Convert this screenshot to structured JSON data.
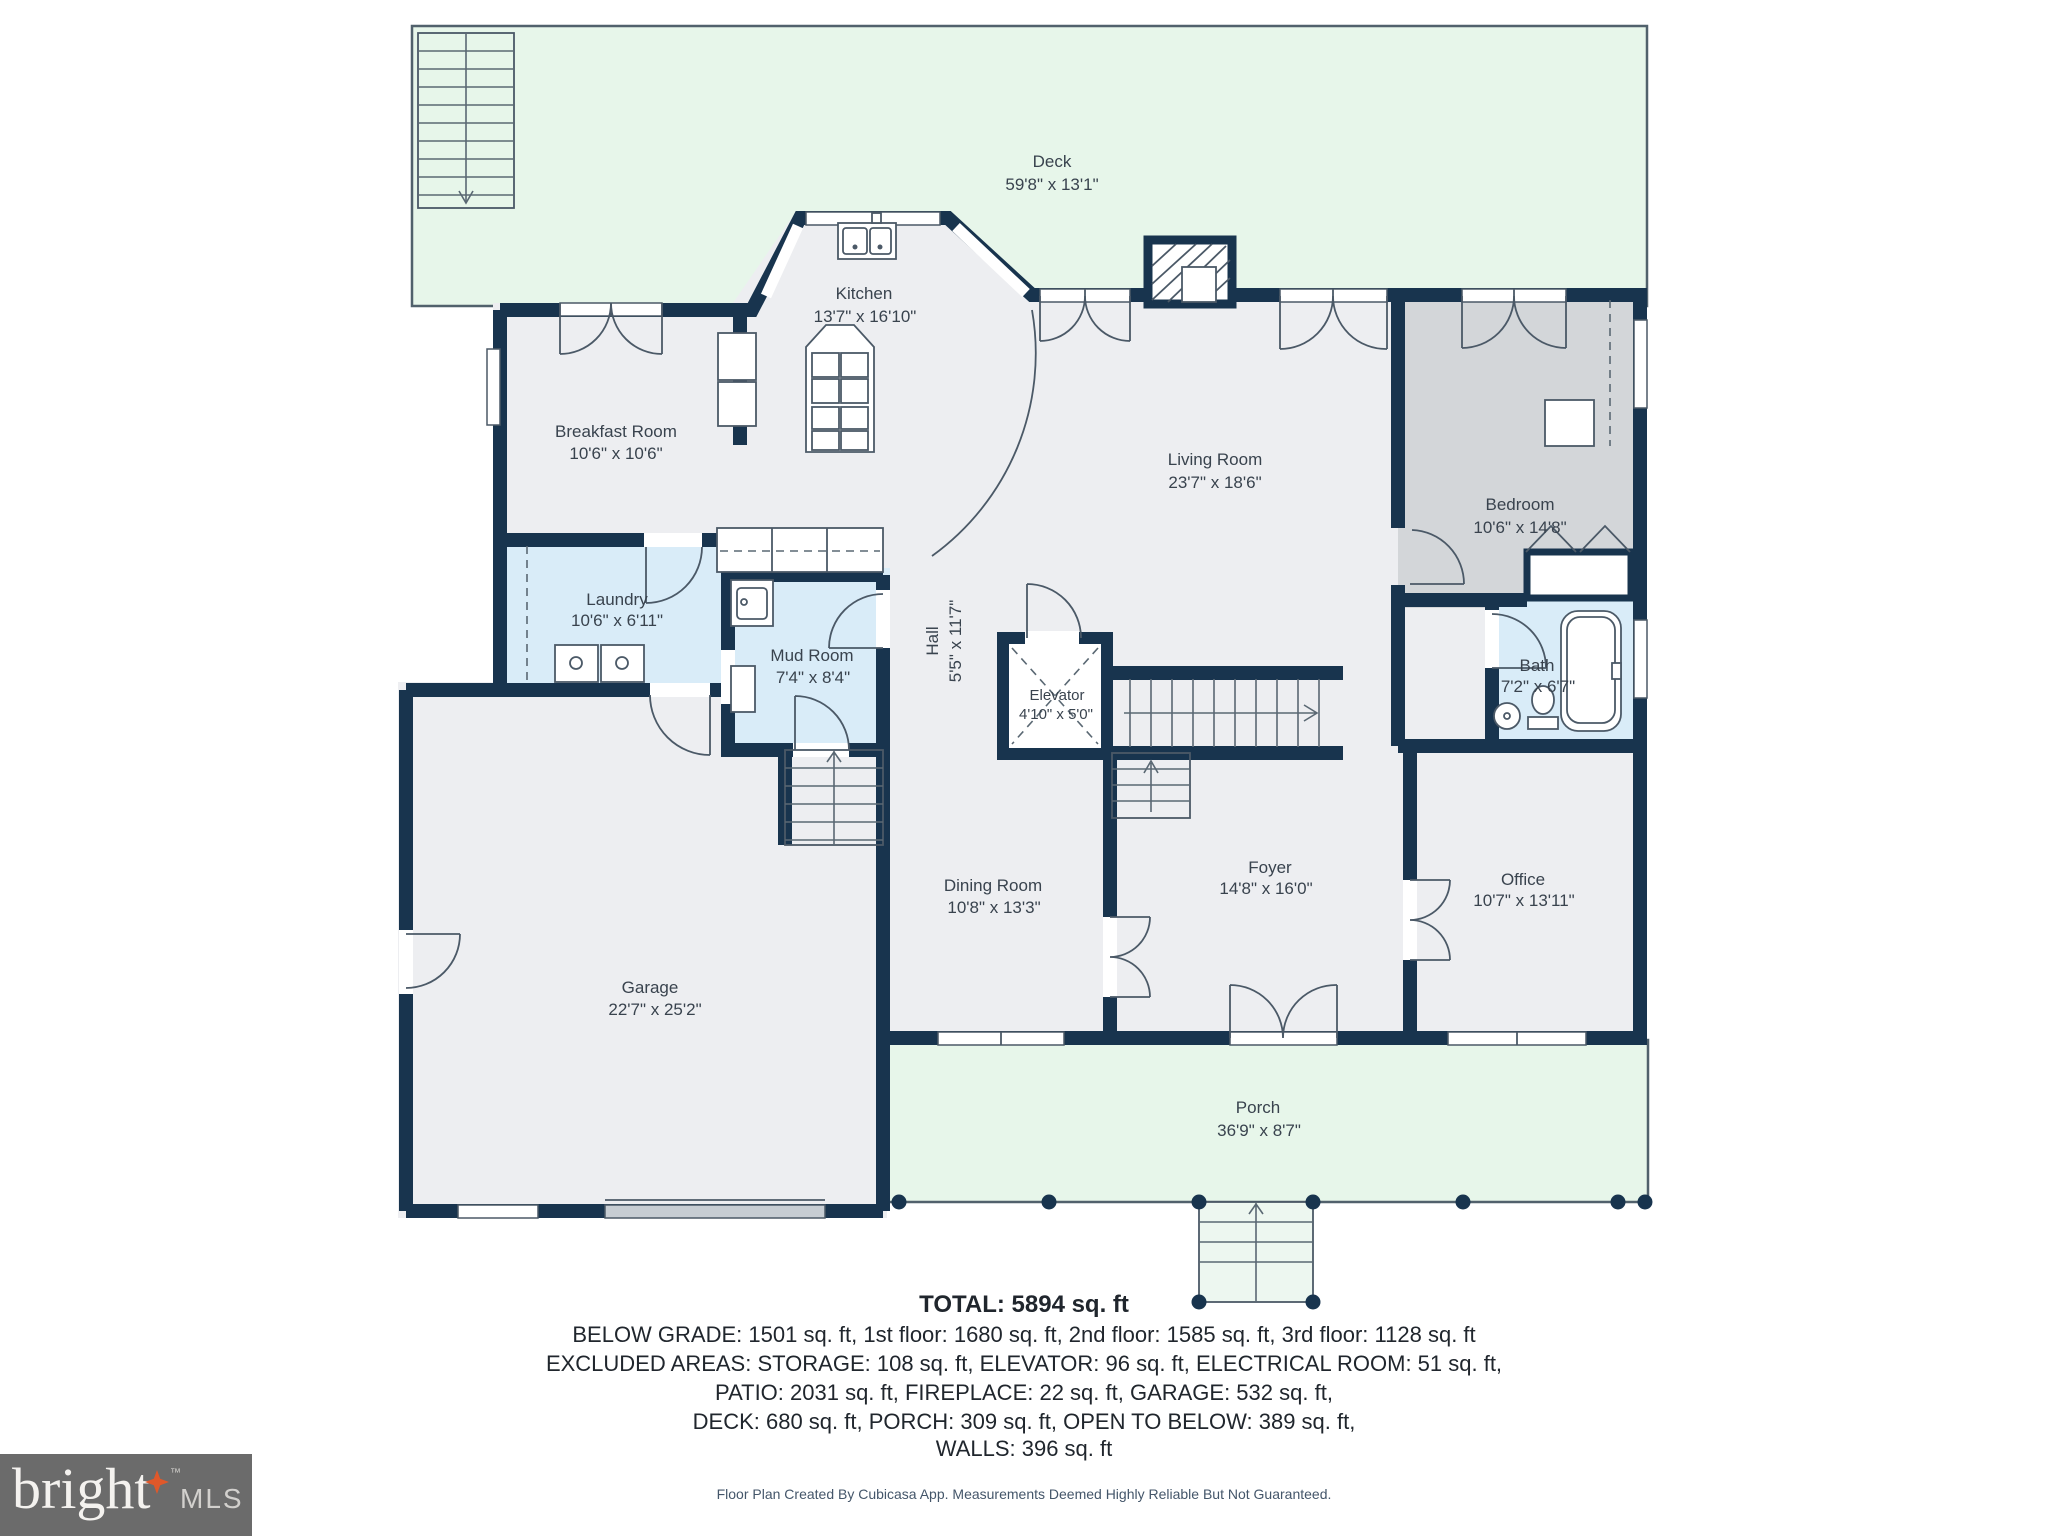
{
  "rooms": [
    {
      "id": "deck",
      "name": "Deck",
      "dims": "59'8\" x 13'1\""
    },
    {
      "id": "kitchen",
      "name": "Kitchen",
      "dims": "13'7\" x 16'10\""
    },
    {
      "id": "breakfast-room",
      "name": "Breakfast Room",
      "dims": "10'6\" x 10'6\""
    },
    {
      "id": "living-room",
      "name": "Living Room",
      "dims": "23'7\" x 18'6\""
    },
    {
      "id": "bedroom",
      "name": "Bedroom",
      "dims": "10'6\" x 14'8\""
    },
    {
      "id": "laundry",
      "name": "Laundry",
      "dims": "10'6\" x 6'11\""
    },
    {
      "id": "mud-room",
      "name": "Mud Room",
      "dims": "7'4\" x 8'4\""
    },
    {
      "id": "hall",
      "name": "Hall",
      "dims": "5'5\" x 11'7\""
    },
    {
      "id": "elevator",
      "name": "Elevator",
      "dims": "4'10\" x 5'0\""
    },
    {
      "id": "bath",
      "name": "Bath",
      "dims": "7'2\" x 6'7\""
    },
    {
      "id": "garage",
      "name": "Garage",
      "dims": "22'7\" x 25'2\""
    },
    {
      "id": "dining-room",
      "name": "Dining Room",
      "dims": "10'8\" x 13'3\""
    },
    {
      "id": "foyer",
      "name": "Foyer",
      "dims": "14'8\" x 16'0\""
    },
    {
      "id": "office",
      "name": "Office",
      "dims": "10'7\" x 13'11\""
    },
    {
      "id": "porch",
      "name": "Porch",
      "dims": "36'9\" x 8'7\""
    }
  ],
  "summary": {
    "total": "TOTAL: 5894 sq. ft",
    "lines": [
      "BELOW GRADE: 1501 sq. ft, 1st floor: 1680 sq. ft, 2nd floor: 1585 sq. ft, 3rd floor: 1128 sq. ft",
      "EXCLUDED AREAS: STORAGE: 108 sq. ft, ELEVATOR: 96 sq. ft, ELECTRICAL ROOM: 51 sq. ft,",
      "PATIO: 2031 sq. ft, FIREPLACE: 22 sq. ft, GARAGE: 532 sq. ft,",
      "DECK: 680 sq. ft, PORCH: 309 sq. ft, OPEN TO BELOW: 389 sq. ft,",
      "WALLS: 396 sq. ft"
    ]
  },
  "footer": {
    "disclaimer": "Floor Plan Created By Cubicasa App. Measurements Deemed Highly Reliable But Not Guaranteed."
  },
  "logo": {
    "brand": "bright",
    "suffix": "MLS",
    "trademark": "™"
  },
  "colors": {
    "wall": "#18344e",
    "floor": "#edeef1",
    "bedroom_floor": "#d3d6d9",
    "wet_room_floor": "#d9ecf8",
    "outdoor": "#e7f6ea",
    "garage_door": "#c7cdd3",
    "label_text": "#39434e",
    "summary_text": "#20262d",
    "logo_background": "#6b6b6b",
    "logo_star": "#e0582a"
  }
}
